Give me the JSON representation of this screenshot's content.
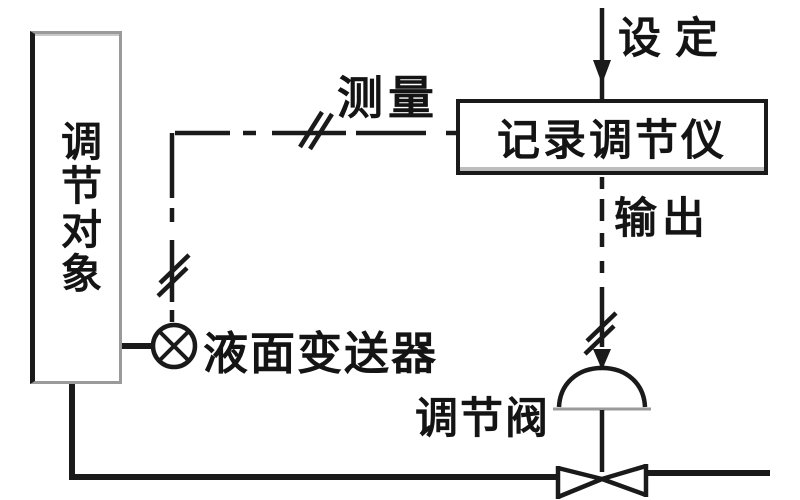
{
  "diagram": {
    "blocks": {
      "controlled_object": "调节对象",
      "controller": "记录调节仪"
    },
    "signals": {
      "setpoint": "设定",
      "measurement": "测量",
      "output": "输出"
    },
    "components": {
      "transmitter": "液面变送器",
      "valve": "调节阀"
    },
    "icons": {
      "transmitter": "circle-with-x-icon",
      "valve_actuator": "dome-actuator-icon",
      "valve_body": "bowtie-valve-icon",
      "arrows": "arrow-down-icon",
      "signal_breaks": "double-slash-break-icon"
    },
    "colors": {
      "line": "#1a1a1a",
      "background": "#ffffff",
      "shadow_gray": "#9a9a9a"
    }
  }
}
